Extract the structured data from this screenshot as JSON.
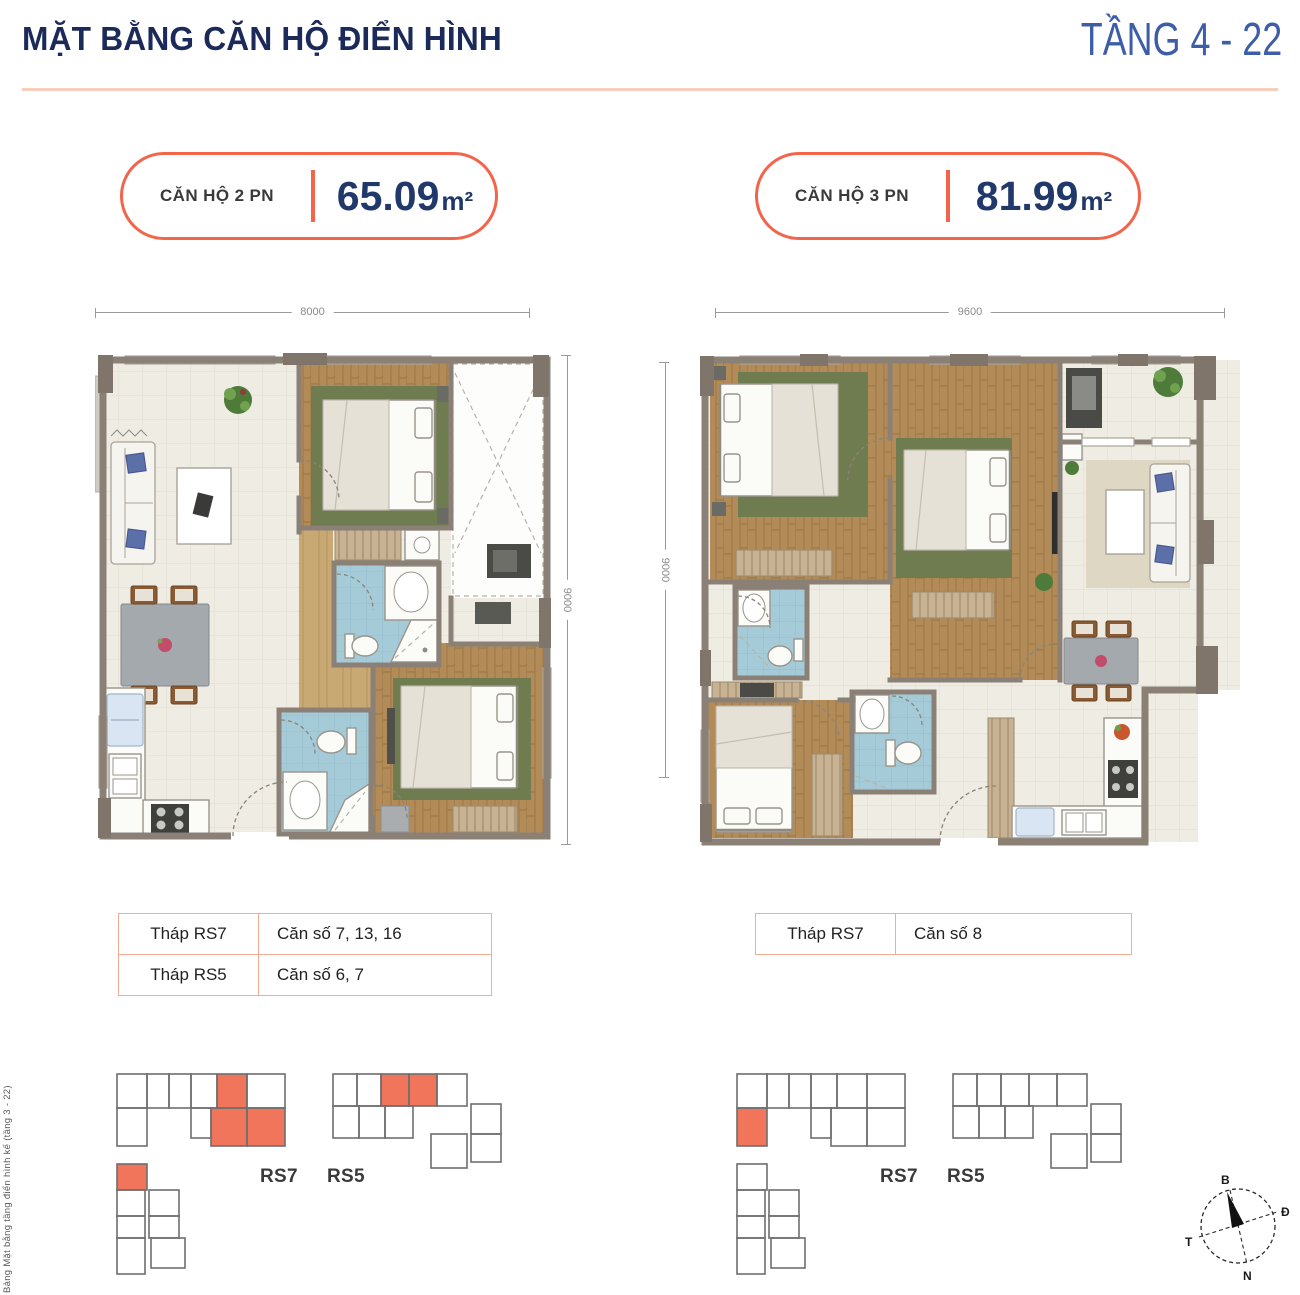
{
  "header": {
    "title": "MẶT BẰNG CĂN HỘ ĐIỂN HÌNH",
    "floor_range": "TẦNG 4 - 22"
  },
  "side_note": "Bảng Mặt bằng tầng điển hình kế (tầng 3 - 22)",
  "unit_left": {
    "badge_label": "CĂN HỘ 2 PN",
    "area": "65.09",
    "area_unit": "m²",
    "dim_width": "8000",
    "dim_height": "9000",
    "rows": [
      {
        "tower": "Tháp RS7",
        "units": "Căn số 7, 13, 16"
      },
      {
        "tower": "Tháp RS5",
        "units": "Căn số 6, 7"
      }
    ]
  },
  "unit_right": {
    "badge_label": "CĂN HỘ 3 PN",
    "area": "81.99",
    "area_unit": "m²",
    "dim_width": "9600",
    "dim_height": "9000",
    "rows": [
      {
        "tower": "Tháp RS7",
        "units": "Căn số 8"
      }
    ]
  },
  "keyplan": {
    "tower_a": "RS7",
    "tower_b": "RS5"
  },
  "compass": {
    "n": "B",
    "e": "Đ",
    "s": "N",
    "w": "T"
  },
  "colors": {
    "accent": "#F2654A",
    "navy_title": "#1B2A58",
    "blue_floors": "#3D5DA9",
    "area_navy": "#21386B",
    "divider": "#F8CDBC",
    "table_border": "#F5AB92",
    "keyplan_highlight": "#F0755A",
    "wall": "#8A8076",
    "bathroom_blue": "#A5CBD9",
    "wood": "#B28B58"
  }
}
